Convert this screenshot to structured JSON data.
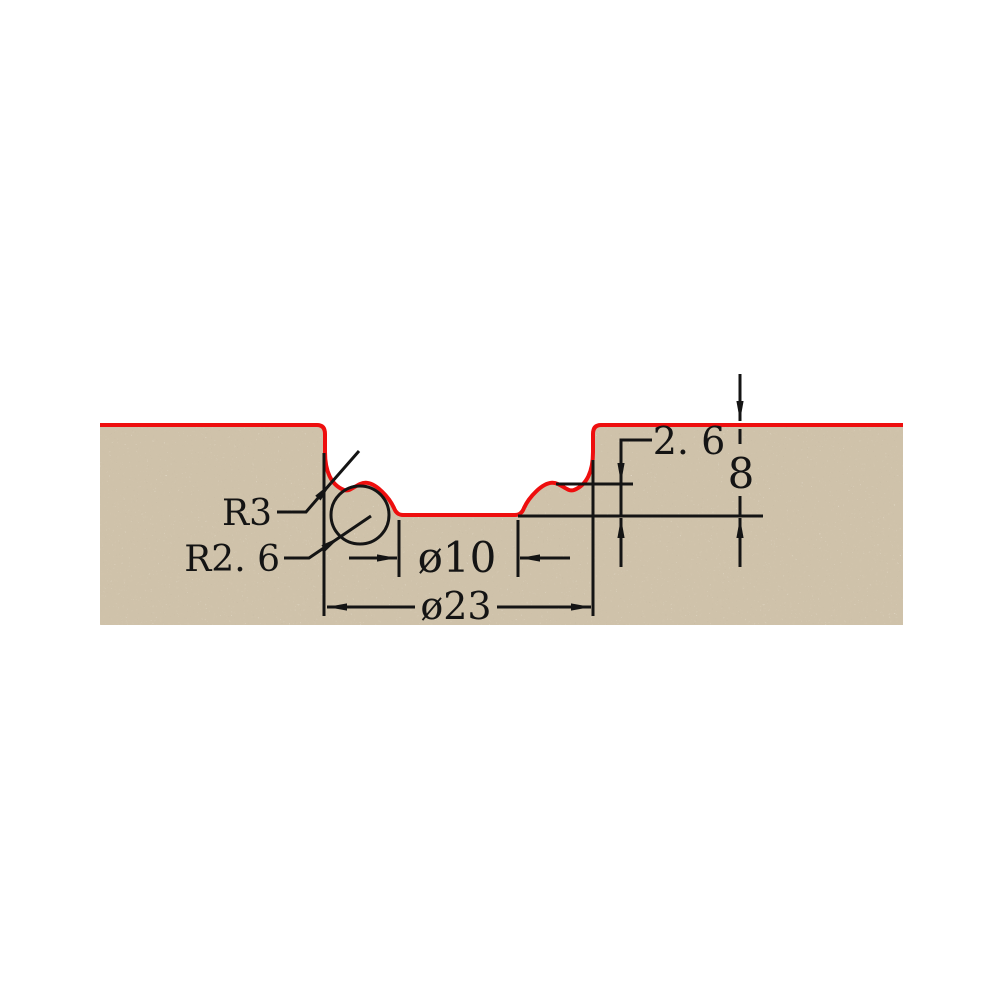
{
  "drawing": {
    "title": "router-bit-edge-profile-cross-section",
    "colors": {
      "background": "#ffffff",
      "material_base": "#cfc2aa",
      "material_speckle_dark": "#7d6c52",
      "material_speckle_light": "#f2ead9",
      "profile_outline": "#ee0e0e",
      "annotation": "#141414"
    },
    "labels": {
      "radius_large": "R3",
      "radius_small": "R2. 6",
      "inner_diameter": "ø10",
      "outer_diameter": "ø23",
      "step_depth": "2. 6",
      "total_depth": "8"
    },
    "values": {
      "radius_large_mm": 3,
      "radius_small_mm": 2.6,
      "inner_diameter_mm": 10,
      "outer_diameter_mm": 23,
      "step_depth_mm": 2.6,
      "total_depth_mm": 8
    }
  }
}
